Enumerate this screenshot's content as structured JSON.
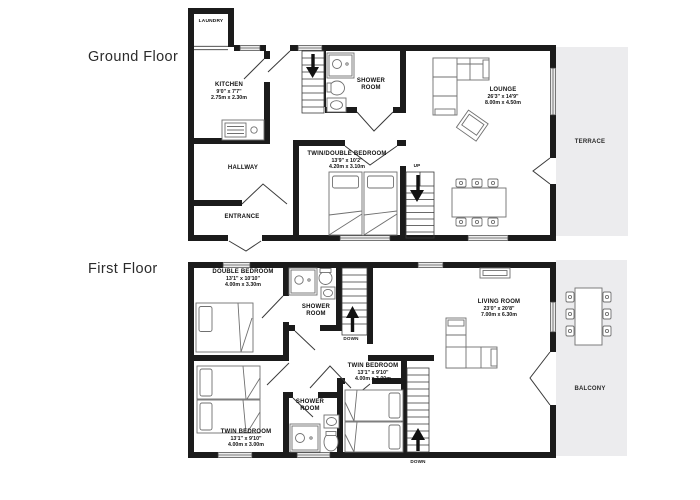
{
  "floors": {
    "ground": {
      "label": "Ground Floor",
      "rooms": {
        "laundry": {
          "name": "LAUNDRY"
        },
        "kitchen": {
          "name": "KITCHEN",
          "dims_ft": "9'0\" x 7'7\"",
          "dims_m": "2.75m x 2.30m"
        },
        "shower_room": {
          "name": "SHOWER ROOM"
        },
        "hallway": {
          "name": "HALLWAY"
        },
        "entrance": {
          "name": "ENTRANCE"
        },
        "twin_double_bedroom": {
          "name": "TWIN/DOUBLE BEDROOM",
          "dims_ft": "13'9\" x 10'2\"",
          "dims_m": "4.20m x 3.10m"
        },
        "lounge": {
          "name": "LOUNGE",
          "dims_ft": "26'3\" x 14'9\"",
          "dims_m": "8.00m x 4.50m"
        },
        "terrace": {
          "name": "TERRACE"
        }
      },
      "stairs": {
        "up_label": "UP"
      }
    },
    "first": {
      "label": "First Floor",
      "rooms": {
        "double_bedroom": {
          "name": "DOUBLE BEDROOM",
          "dims_ft": "13'1\" x 10'10\"",
          "dims_m": "4.00m x 3.30m"
        },
        "shower_room_top": {
          "name": "SHOWER ROOM"
        },
        "living_room": {
          "name": "LIVING ROOM",
          "dims_ft": "23'0\" x 20'8\"",
          "dims_m": "7.00m x 6.30m"
        },
        "twin_bedroom_left": {
          "name": "TWIN BEDROOM",
          "dims_ft": "13'1\" x 9'10\"",
          "dims_m": "4.00m x 3.00m"
        },
        "shower_room_bottom": {
          "name": "SHOWER ROOM"
        },
        "twin_bedroom_right": {
          "name": "TWIN BEDROOM",
          "dims_ft": "13'1\" x 9'10\"",
          "dims_m": "4.00m x 3.00m"
        },
        "balcony": {
          "name": "BALCONY"
        }
      },
      "stairs": {
        "down_label_top": "DOWN",
        "down_label_bottom": "DOWN"
      }
    }
  },
  "colors": {
    "wall": "#1b1b1b",
    "outdoor_fill": "#ececee",
    "furniture_line": "#707070",
    "label_text": "#111111"
  }
}
